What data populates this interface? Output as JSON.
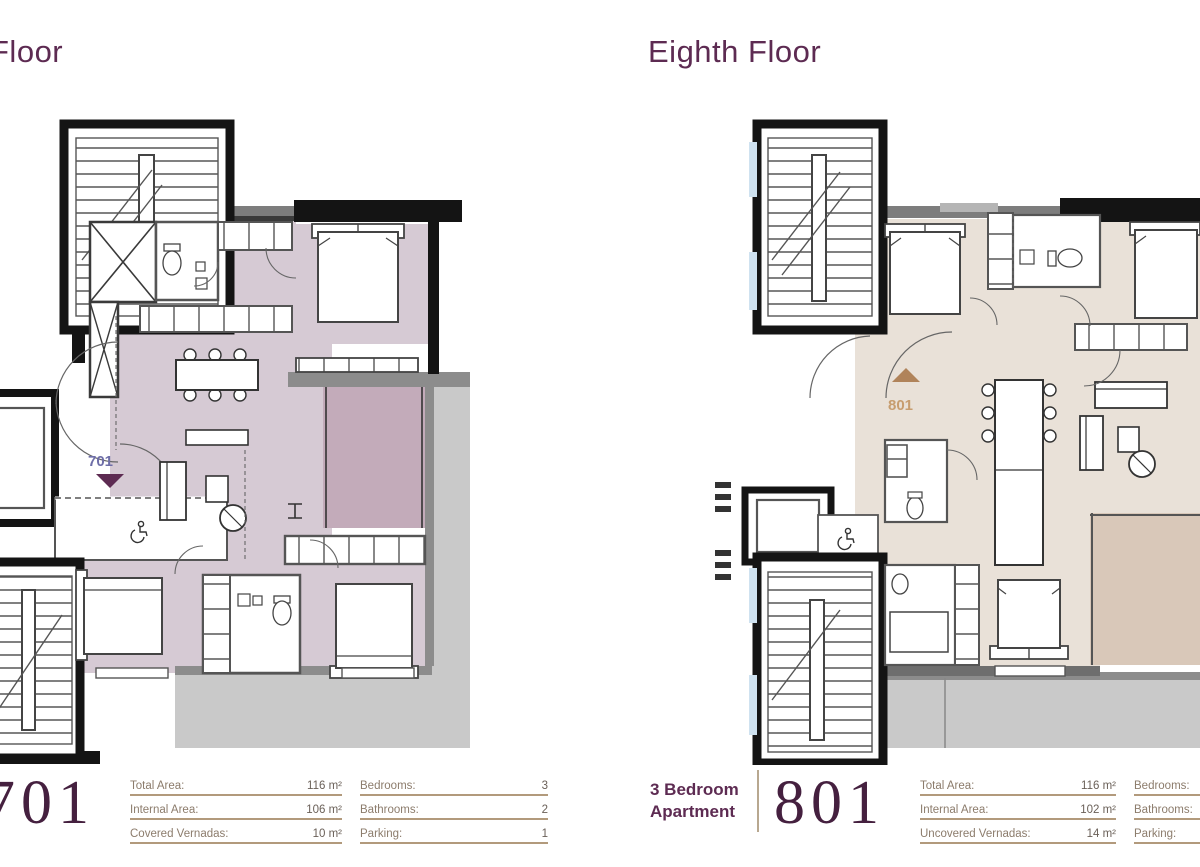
{
  "theme": {
    "title_color": "#5d2b52",
    "number_color": "#45203f",
    "spec_line_color": "#b29a7c",
    "terrace_color": "#c9c9c9",
    "wall_color": "#141414"
  },
  "left": {
    "title": "Floor",
    "unit_marker": "701",
    "big_number": "701",
    "room_fill": "#d6cad4",
    "veranda_fill": "#c3abba",
    "marker_color": "#6e6ea8",
    "marker_triangle_color": "#5d2b52",
    "specs_left": [
      {
        "label": "Total Area:",
        "value": "116 m²"
      },
      {
        "label": "Internal Area:",
        "value": "106 m²"
      },
      {
        "label": "Covered Vernadas:",
        "value": "10 m²"
      }
    ],
    "specs_right": [
      {
        "label": "Bedrooms:",
        "value": "3"
      },
      {
        "label": "Bathrooms:",
        "value": "2"
      },
      {
        "label": "Parking:",
        "value": "1"
      }
    ]
  },
  "right": {
    "title": "Eighth Floor",
    "type_line1": "3 Bedroom",
    "type_line2": "Apartment",
    "unit_marker": "801",
    "big_number": "801",
    "room_fill": "#e9e1d8",
    "veranda_fill": "#d9c8b9",
    "marker_color": "#c79d6f",
    "marker_triangle_color": "#b0835a",
    "specs_left": [
      {
        "label": "Total Area:",
        "value": "116 m²"
      },
      {
        "label": "Internal Area:",
        "value": "102 m²"
      },
      {
        "label": "Uncovered Vernadas:",
        "value": "14 m²"
      }
    ],
    "specs_right": [
      {
        "label": "Bedrooms:",
        "value": ""
      },
      {
        "label": "Bathrooms:",
        "value": ""
      },
      {
        "label": "Parking:",
        "value": ""
      }
    ]
  }
}
